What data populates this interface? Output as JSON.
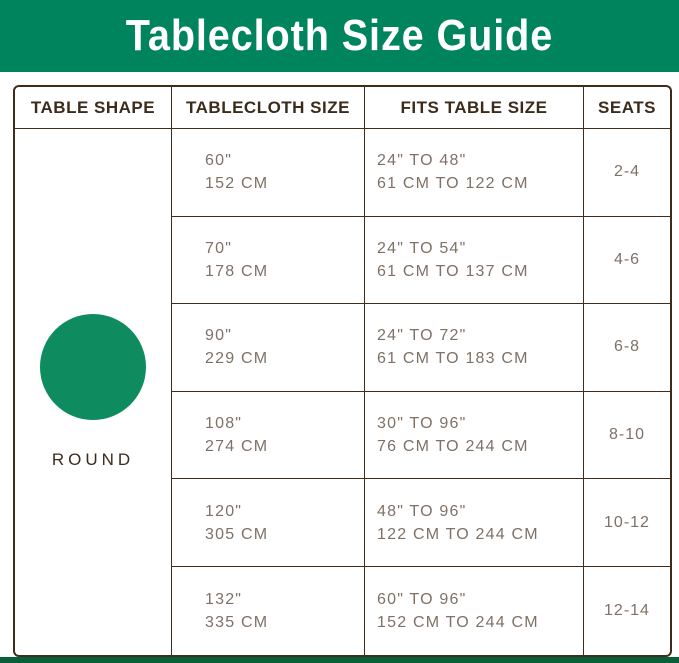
{
  "title": "Tablecloth Size Guide",
  "colors": {
    "banner_green": "#00845D",
    "circle_green": "#0E8C5F",
    "bottom_bar_green": "#0A5F38",
    "border_brown": "#3E2D1D",
    "header_text": "#3B2B1B",
    "body_text": "#7E7165"
  },
  "table": {
    "headers": [
      "TABLE SHAPE",
      "TABLECLOTH SIZE",
      "FITS TABLE SIZE",
      "SEATS"
    ],
    "shape": {
      "label": "ROUND",
      "icon": "green-filled-circle"
    },
    "rows": [
      {
        "size_in": "60\"",
        "size_cm": "152 CM",
        "fits_in": "24\" TO 48\"",
        "fits_cm": "61 CM TO 122 CM",
        "seats": "2-4"
      },
      {
        "size_in": "70\"",
        "size_cm": "178 CM",
        "fits_in": "24\" TO 54\"",
        "fits_cm": "61 CM TO 137 CM",
        "seats": "4-6"
      },
      {
        "size_in": "90\"",
        "size_cm": "229 CM",
        "fits_in": "24\" TO 72\"",
        "fits_cm": "61 CM TO 183 CM",
        "seats": "6-8"
      },
      {
        "size_in": "108\"",
        "size_cm": "274 CM",
        "fits_in": "30\" TO 96\"",
        "fits_cm": "76 CM TO 244 CM",
        "seats": "8-10"
      },
      {
        "size_in": "120\"",
        "size_cm": "305 CM",
        "fits_in": "48\" TO 96\"",
        "fits_cm": "122 CM TO 244 CM",
        "seats": "10-12"
      },
      {
        "size_in": "132\"",
        "size_cm": "335 CM",
        "fits_in": "60\" TO 96\"",
        "fits_cm": "152 CM TO 244 CM",
        "seats": "12-14"
      }
    ]
  },
  "chart_data": {
    "type": "table",
    "title": "Tablecloth Size Guide",
    "columns": [
      "TABLE SHAPE",
      "TABLECLOTH SIZE",
      "FITS TABLE SIZE",
      "SEATS"
    ],
    "rows": [
      [
        "ROUND",
        "60\" / 152 CM",
        "24\" TO 48\" / 61 CM TO 122 CM",
        "2-4"
      ],
      [
        "ROUND",
        "70\" / 178 CM",
        "24\" TO 54\" / 61 CM TO 137 CM",
        "4-6"
      ],
      [
        "ROUND",
        "90\" / 229 CM",
        "24\" TO 72\" / 61 CM TO 183 CM",
        "6-8"
      ],
      [
        "ROUND",
        "108\" / 274 CM",
        "30\" TO 96\" / 76 CM TO 244 CM",
        "8-10"
      ],
      [
        "ROUND",
        "120\" / 305 CM",
        "48\" TO 96\" / 122 CM TO 244 CM",
        "10-12"
      ],
      [
        "ROUND",
        "132\" / 335 CM",
        "60\" TO 96\" / 152 CM TO 244 CM",
        "12-14"
      ]
    ]
  }
}
